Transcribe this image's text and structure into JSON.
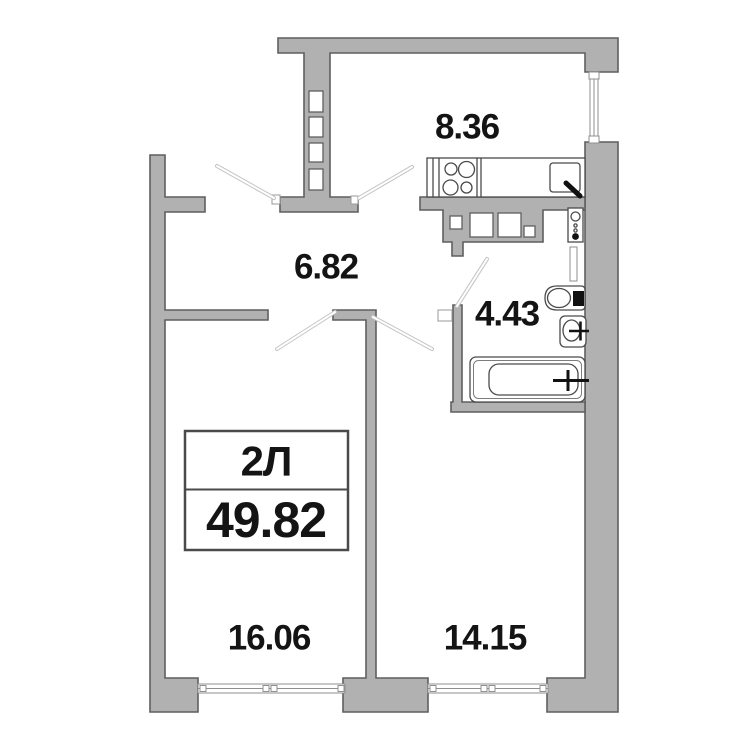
{
  "apartment": {
    "type_label": "2Л",
    "total_area": "49.82"
  },
  "rooms": [
    {
      "name": "kitchen",
      "area": "8.36"
    },
    {
      "name": "hallway",
      "area": "6.82"
    },
    {
      "name": "bathroom",
      "area": "4.43"
    },
    {
      "name": "room-left",
      "area": "16.06"
    },
    {
      "name": "room-right",
      "area": "14.15"
    }
  ],
  "symbols": [
    "stove-burners-icon",
    "kitchen-sink-icon",
    "faucet-icon",
    "plumbing-riser-icon",
    "toilet-icon",
    "washbasin-icon",
    "bathtub-icon",
    "vent-shaft",
    "window",
    "door-leaf"
  ],
  "colors": {
    "wall_fill": "#b1b1b1",
    "wall_stroke": "#5f5f5f",
    "fixture_stroke": "#4a4a4a",
    "window_stroke": "#8f8f8f",
    "door_line": "#c4c4c4",
    "text_color": "#141414",
    "info_border": "#4a4a4a",
    "background": "#ffffff"
  }
}
